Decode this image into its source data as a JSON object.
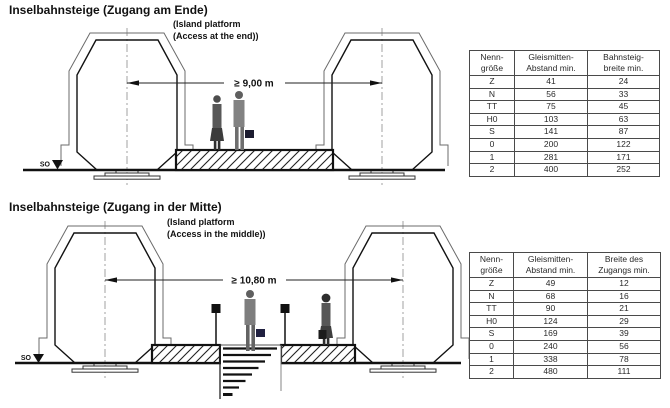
{
  "section1": {
    "title": "Inselbahnsteige (Zugang am Ende)",
    "subtitle": "(Island platform\n(Access at the end))",
    "dimension_label": "≥ 9,00 m",
    "datum_label": "SO",
    "table": {
      "headers": [
        "Nenn-\ngröße",
        "Gleismitten-\nAbstand min.",
        "Bahnsteig-\nbreite min."
      ],
      "rows": [
        [
          "Z",
          "41",
          "24"
        ],
        [
          "N",
          "56",
          "33"
        ],
        [
          "TT",
          "75",
          "45"
        ],
        [
          "H0",
          "103",
          "63"
        ],
        [
          "S",
          "141",
          "87"
        ],
        [
          "0",
          "200",
          "122"
        ],
        [
          "1",
          "281",
          "171"
        ],
        [
          "2",
          "400",
          "252"
        ]
      ]
    }
  },
  "section2": {
    "title": "Inselbahnsteige (Zugang in der Mitte)",
    "subtitle": "(Island platform\n(Access in the middle))",
    "dimension_label": "≥ 10,80 m",
    "datum_label": "SO",
    "table": {
      "headers": [
        "Nenn-\ngröße",
        "Gleismitten-\nAbstand min.",
        "Breite des\nZugangs min."
      ],
      "rows": [
        [
          "Z",
          "49",
          "12"
        ],
        [
          "N",
          "68",
          "16"
        ],
        [
          "TT",
          "90",
          "21"
        ],
        [
          "H0",
          "124",
          "29"
        ],
        [
          "S",
          "169",
          "39"
        ],
        [
          "0",
          "240",
          "56"
        ],
        [
          "1",
          "338",
          "78"
        ],
        [
          "2",
          "480",
          "111"
        ]
      ]
    }
  }
}
